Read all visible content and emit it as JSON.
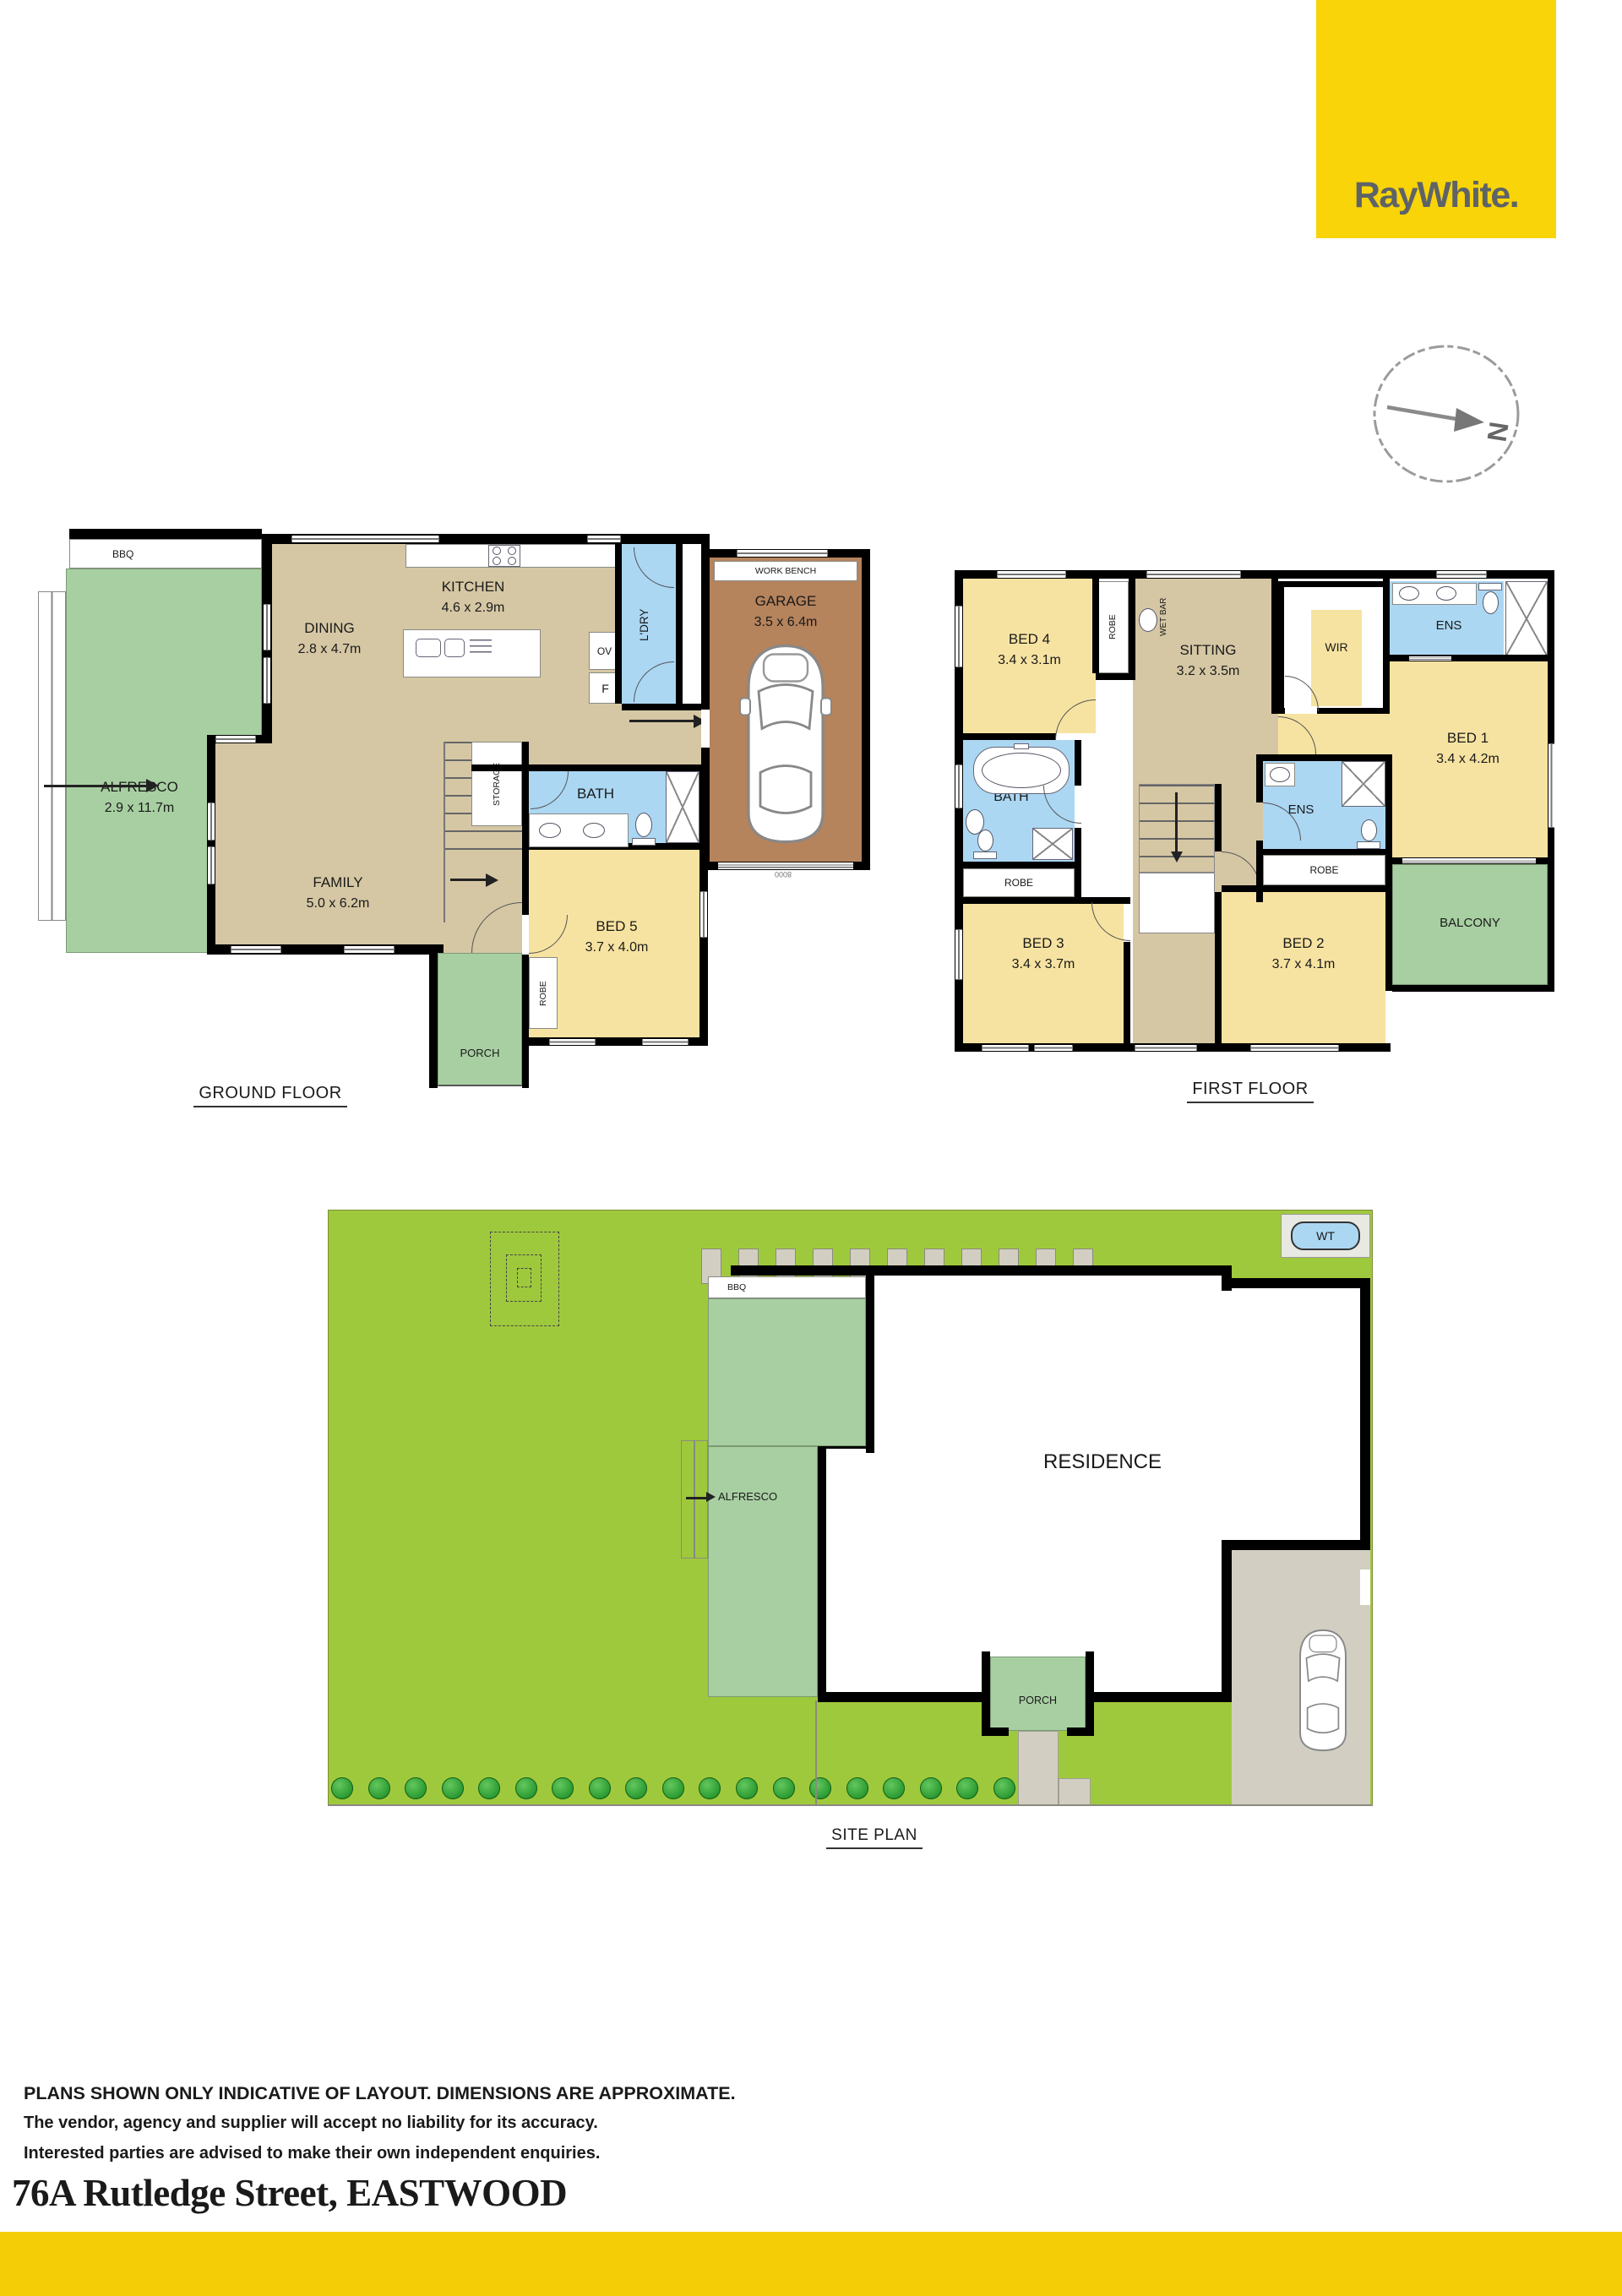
{
  "branding": {
    "logo": "RayWhite.",
    "brand_yellow": "#F8D408",
    "footer_bar_yellow": "#F5CD06",
    "logo_text_gray": "#5E6367"
  },
  "compass": {
    "north": "N"
  },
  "colors": {
    "interior_tan": "#D5C7A4",
    "bedroom_yellow": "#F7E3A1",
    "wet_area_blue": "#ABD7F3",
    "garage_brown": "#B5835C",
    "outdoor_green": "#A8CFA2",
    "lawn_green": "#9FC93C",
    "paving_gray": "#D2CFC2",
    "wall_black": "#000000"
  },
  "ground_floor": {
    "title": "GROUND FLOOR",
    "bbq": "BBQ",
    "alfresco": {
      "name": "ALFRESCO",
      "dim": "2.9 x 11.7m"
    },
    "dining": {
      "name": "DINING",
      "dim": "2.8 x 4.7m"
    },
    "kitchen": {
      "name": "KITCHEN",
      "dim": "4.6 x 2.9m"
    },
    "laundry": "L'DRY",
    "oven": "OV",
    "fridge": "F",
    "work_bench": "WORK BENCH",
    "garage": {
      "name": "GARAGE",
      "dim": "3.5 x 6.4m"
    },
    "garage_door": "8000",
    "storage": "STORAGE",
    "bath": "BATH",
    "family": {
      "name": "FAMILY",
      "dim": "5.0 x 6.2m"
    },
    "bed5": {
      "name": "BED 5",
      "dim": "3.7 x 4.0m"
    },
    "robe": "ROBE",
    "porch": "PORCH"
  },
  "first_floor": {
    "title": "FIRST FLOOR",
    "bed4": {
      "name": "BED 4",
      "dim": "3.4 x 3.1m"
    },
    "robe4": "ROBE",
    "wet_bar": "WET BAR",
    "sitting": {
      "name": "SITTING",
      "dim": "3.2 x 3.5m"
    },
    "wir": "WIR",
    "ens1": "ENS",
    "bed1": {
      "name": "BED 1",
      "dim": "3.4 x 4.2m"
    },
    "bath": "BATH",
    "robe3": "ROBE",
    "bed3": {
      "name": "BED 3",
      "dim": "3.4 x 3.7m"
    },
    "ens2": "ENS",
    "robe2": "ROBE",
    "bed2": {
      "name": "BED 2",
      "dim": "3.7 x 4.1m"
    },
    "balcony": "BALCONY"
  },
  "site_plan": {
    "title": "SITE PLAN",
    "wt": "WT",
    "bbq": "BBQ",
    "alfresco": "ALFRESCO",
    "residence": "RESIDENCE",
    "porch": "PORCH"
  },
  "footer": {
    "line1": "PLANS SHOWN ONLY INDICATIVE OF LAYOUT. DIMENSIONS ARE APPROXIMATE.",
    "line2": "The vendor, agency and supplier will accept no liability for its accuracy.",
    "line3": "Interested parties are advised to make their own independent enquiries.",
    "address": "76A Rutledge Street, EASTWOOD"
  }
}
